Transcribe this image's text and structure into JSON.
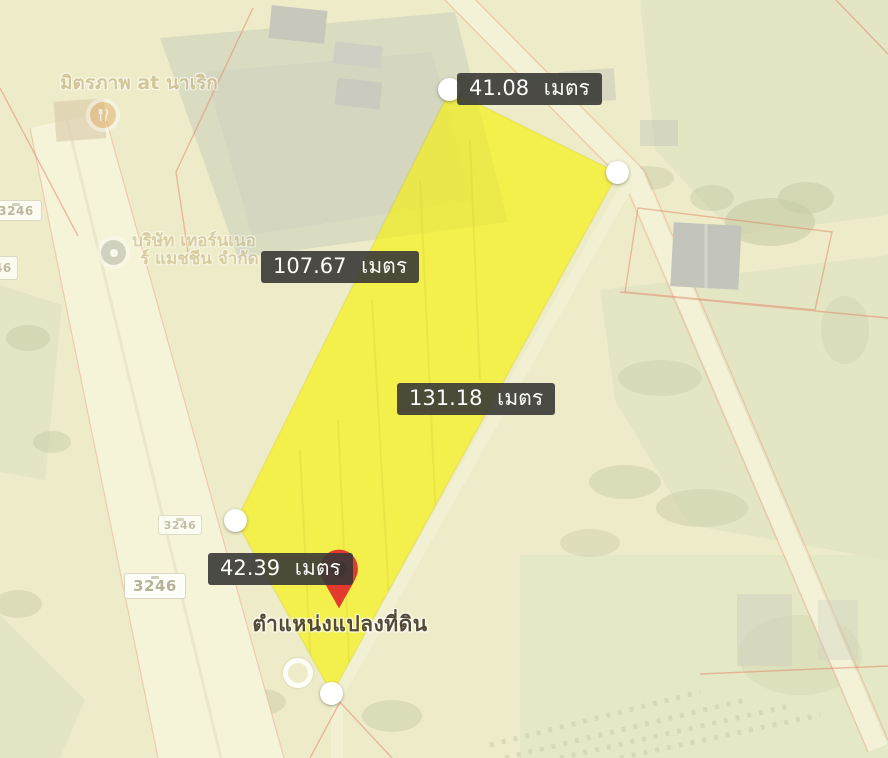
{
  "measurements": [
    {
      "label": "41.08 เมตร"
    },
    {
      "label": "107.67 เมตร"
    },
    {
      "label": "131.18 เมตร"
    },
    {
      "label": "42.39 เมตร"
    }
  ],
  "pin": {
    "caption": "ตำแหน่งแปลงที่ดิน"
  },
  "pois": [
    {
      "label": "มิตรภาพ at นาเริก"
    },
    {
      "label_line1": "บริษัท เทอร์นเนอ",
      "label_line2": "ร์ แมชชีน จำกัด"
    }
  ],
  "road_shields": {
    "highway_number": "3246"
  },
  "colors": {
    "parcel_fill": "#f5f200",
    "label_bg": "#3a3a38",
    "pin_red": "#e23b2e",
    "map_base": "#eeecc8"
  }
}
